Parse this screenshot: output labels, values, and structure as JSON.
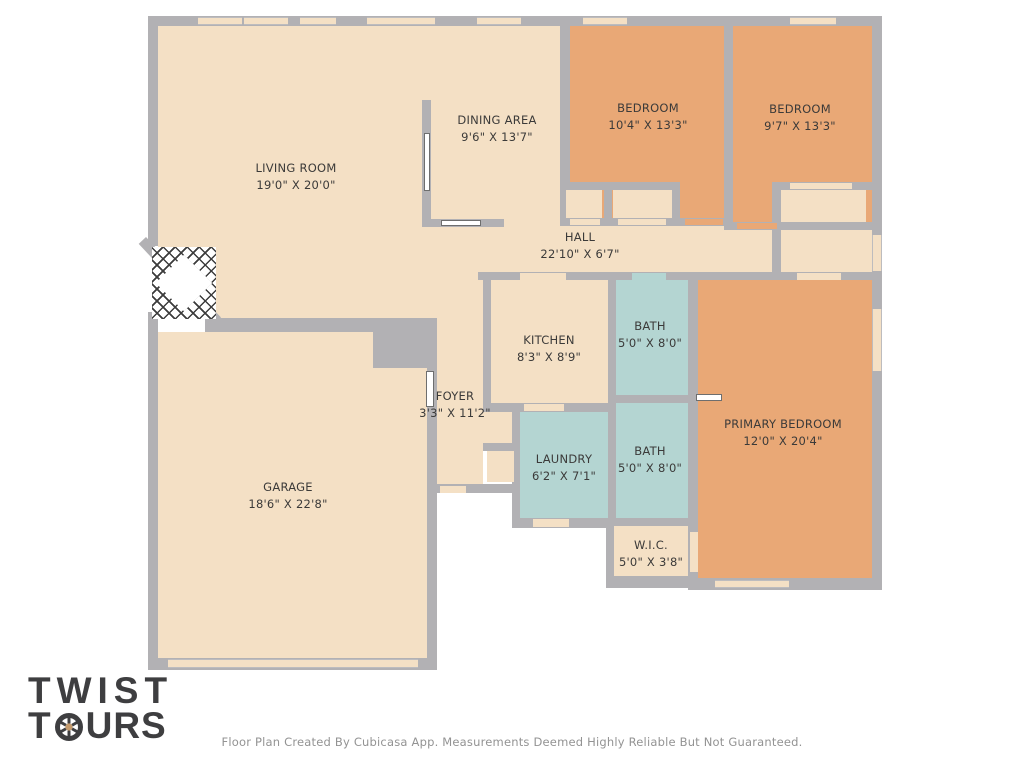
{
  "branding": {
    "logo_line1": "TWIST",
    "logo_line2_prefix": "T",
    "logo_line2_suffix": "URS",
    "aperture_icon": "camera-aperture-icon"
  },
  "footer": {
    "disclaimer": "Floor Plan Created By Cubicasa App. Measurements Deemed Highly Reliable But Not Guaranteed."
  },
  "colors": {
    "floor": "#f4e0c5",
    "bedroom": "#e9a876",
    "wet": "#b4d5d2",
    "wall": "#b2b1b4",
    "label": "#3b3a39",
    "logo": "#3e3e40",
    "footer": "#939393"
  },
  "rooms": [
    {
      "name": "LIVING ROOM",
      "dims": "19'0\" X 20'0\""
    },
    {
      "name": "DINING AREA",
      "dims": "9'6\" X 13'7\""
    },
    {
      "name": "BEDROOM",
      "dims": "10'4\" X 13'3\""
    },
    {
      "name": "BEDROOM",
      "dims": "9'7\" X 13'3\""
    },
    {
      "name": "HALL",
      "dims": "22'10\" X 6'7\""
    },
    {
      "name": "KITCHEN",
      "dims": "8'3\" X 8'9\""
    },
    {
      "name": "BATH",
      "dims": "5'0\" X 8'0\""
    },
    {
      "name": "FOYER",
      "dims": "3'3\" X 11'2\""
    },
    {
      "name": "LAUNDRY",
      "dims": "6'2\" X 7'1\""
    },
    {
      "name": "BATH",
      "dims": "5'0\" X 8'0\""
    },
    {
      "name": "PRIMARY BEDROOM",
      "dims": "12'0\" X 20'4\""
    },
    {
      "name": "W.I.C.",
      "dims": "5'0\" X 3'8\""
    },
    {
      "name": "GARAGE",
      "dims": "18'6\" X 22'8\""
    }
  ]
}
